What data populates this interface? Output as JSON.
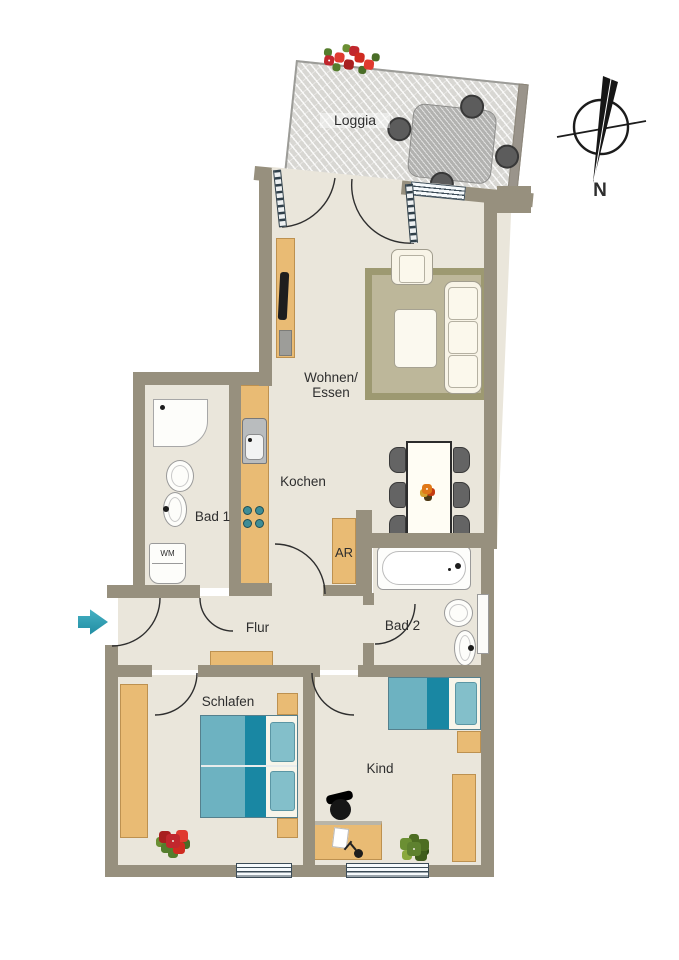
{
  "rooms": {
    "loggia": "Loggia",
    "wohnen": "Wohnen/\nEssen",
    "kochen": "Kochen",
    "bad1": "Bad 1",
    "ar": "AR",
    "bad2": "Bad 2",
    "flur": "Flur",
    "schlafen": "Schlafen",
    "kind": "Kind"
  },
  "labels": {
    "washing_machine": "WM",
    "compass_north": "N"
  },
  "colors": {
    "wall": "#97907e",
    "floor": "#eae6db",
    "wood": "#e9bb74",
    "bed_teal_light": "#6db2c1",
    "bed_teal_dark": "#1987a3",
    "rug": "#bdb79a",
    "rug_border": "#9d9971",
    "chair_gray": "#646464",
    "entry_arrow": "#2aa3b8",
    "flower_red": "#cf2b20",
    "plant_green": "#5e812f"
  }
}
